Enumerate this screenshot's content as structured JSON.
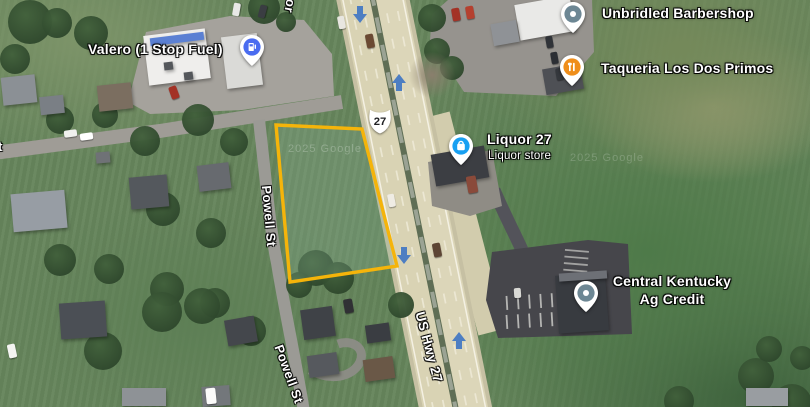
{
  "watermark": "2025 Google",
  "places": [
    {
      "name": "Valero (1 Stop Fuel)"
    },
    {
      "name": "Unbridled Barbershop"
    },
    {
      "name": "Taqueria Los Dos Primos"
    },
    {
      "name": "Liquor 27",
      "subtitle": "Liquor store"
    },
    {
      "line1": "Central Kentucky",
      "line2": "Ag Credit"
    }
  ],
  "roads": {
    "powell_st": "Powell St",
    "powell_st_lower": "Powell St",
    "us_hwy_27": "US Hwy 27",
    "route_shield": "27",
    "cutoff_top": "or",
    "cutoff_left": "t"
  },
  "colors": {
    "parcel_outline": "#F5B40A",
    "parcel_fill": "rgba(140,180,155,0.25)",
    "gas_pin": "#4A6CF0",
    "liquor_pin": "#18A0F2",
    "restaurant_pin": "#EF8E1B",
    "generic_pin": "#6D8794",
    "traffic_arrow": "#4D7EC2"
  }
}
